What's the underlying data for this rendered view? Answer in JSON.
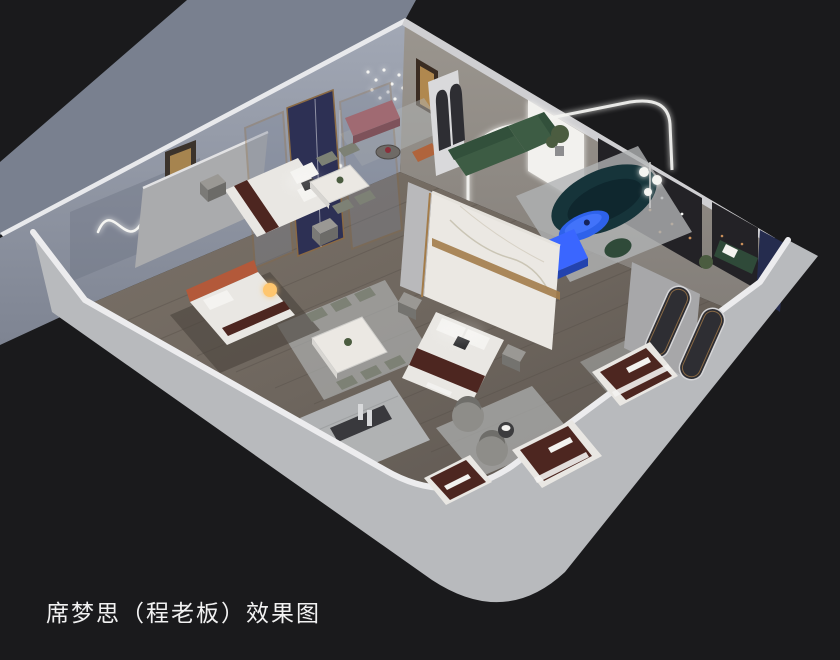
{
  "image": {
    "type": "3d-interior-showroom-rendering",
    "caption": "席梦思（程老板）效果图",
    "view": "isometric cutaway floor plan"
  },
  "palette": {
    "background": "#1a1a1c",
    "wall_exterior_left": "#79808f",
    "wall_interior_left": "#989eac",
    "wall_interior_back": "#918c86",
    "wall_edge_bright": "#e8e9ec",
    "wall_edge_dim": "#cfcfd2",
    "wall_front_band": "#b8babd",
    "floor_wood": "#71685f",
    "floor_plank_dark": "#554e48",
    "rug_light": "#b0b3b4",
    "rug_dark": "#4a423c",
    "stone_tile": "#b4b6b8",
    "marble_white": "#ebe8e3",
    "gold_trim": "#a37c4a",
    "wood_frame": "#8a6a45",
    "navy_fabric": "#2d3054",
    "bed_white": "#e9e7e3",
    "runner_burgundy": "#4d2620",
    "logo_white": "#f3f2ef",
    "headboard_orange": "#b3593a",
    "bench_mauve": "#a06a72",
    "sofa_green": "#3d5c44",
    "sofa_teal_dark": "#16343a",
    "coffee_table_blue": "#2e62ea",
    "console_blue": "#3a66ff",
    "chair_sage": "#7d8175",
    "chair_gray": "#8e8d89",
    "panel_dark": "#232226",
    "panel_navy": "#252c4e",
    "panel_backlit": "#f2f1ee",
    "nightstand_gray": "#9a9894",
    "lamp_warm": "#ffc66e",
    "led_white": "#f5f5f2",
    "string_light_copper": "#c98f5a",
    "mirror_dark": "#2e2e33",
    "plant_green": "#4b5c40",
    "bench_green": "#2f4a39",
    "caption_color": "#f2f2f2"
  },
  "scene": {
    "objects": [
      "showroom-shell",
      "wood-floor",
      "display-bed-navy-headboard",
      "display-bed-orange-headboard",
      "display-bed-marble-partition",
      "display-mattress-1",
      "display-mattress-2",
      "display-mattress-3",
      "dining-set-four-chairs",
      "dining-set-six-chairs",
      "green-sectional-sofa",
      "teal-curved-sofa",
      "blue-oval-coffee-table",
      "blue-tv-console",
      "mauve-bench",
      "swivel-lounge-chairs",
      "arched-mirrors",
      "led-arch-portal",
      "wavy-neon-wall-art",
      "dot-chandelier",
      "string-light-panels",
      "backlit-wall-panel",
      "navy-wall-panel",
      "marble-walkway",
      "glow-sphere-lamp"
    ]
  }
}
